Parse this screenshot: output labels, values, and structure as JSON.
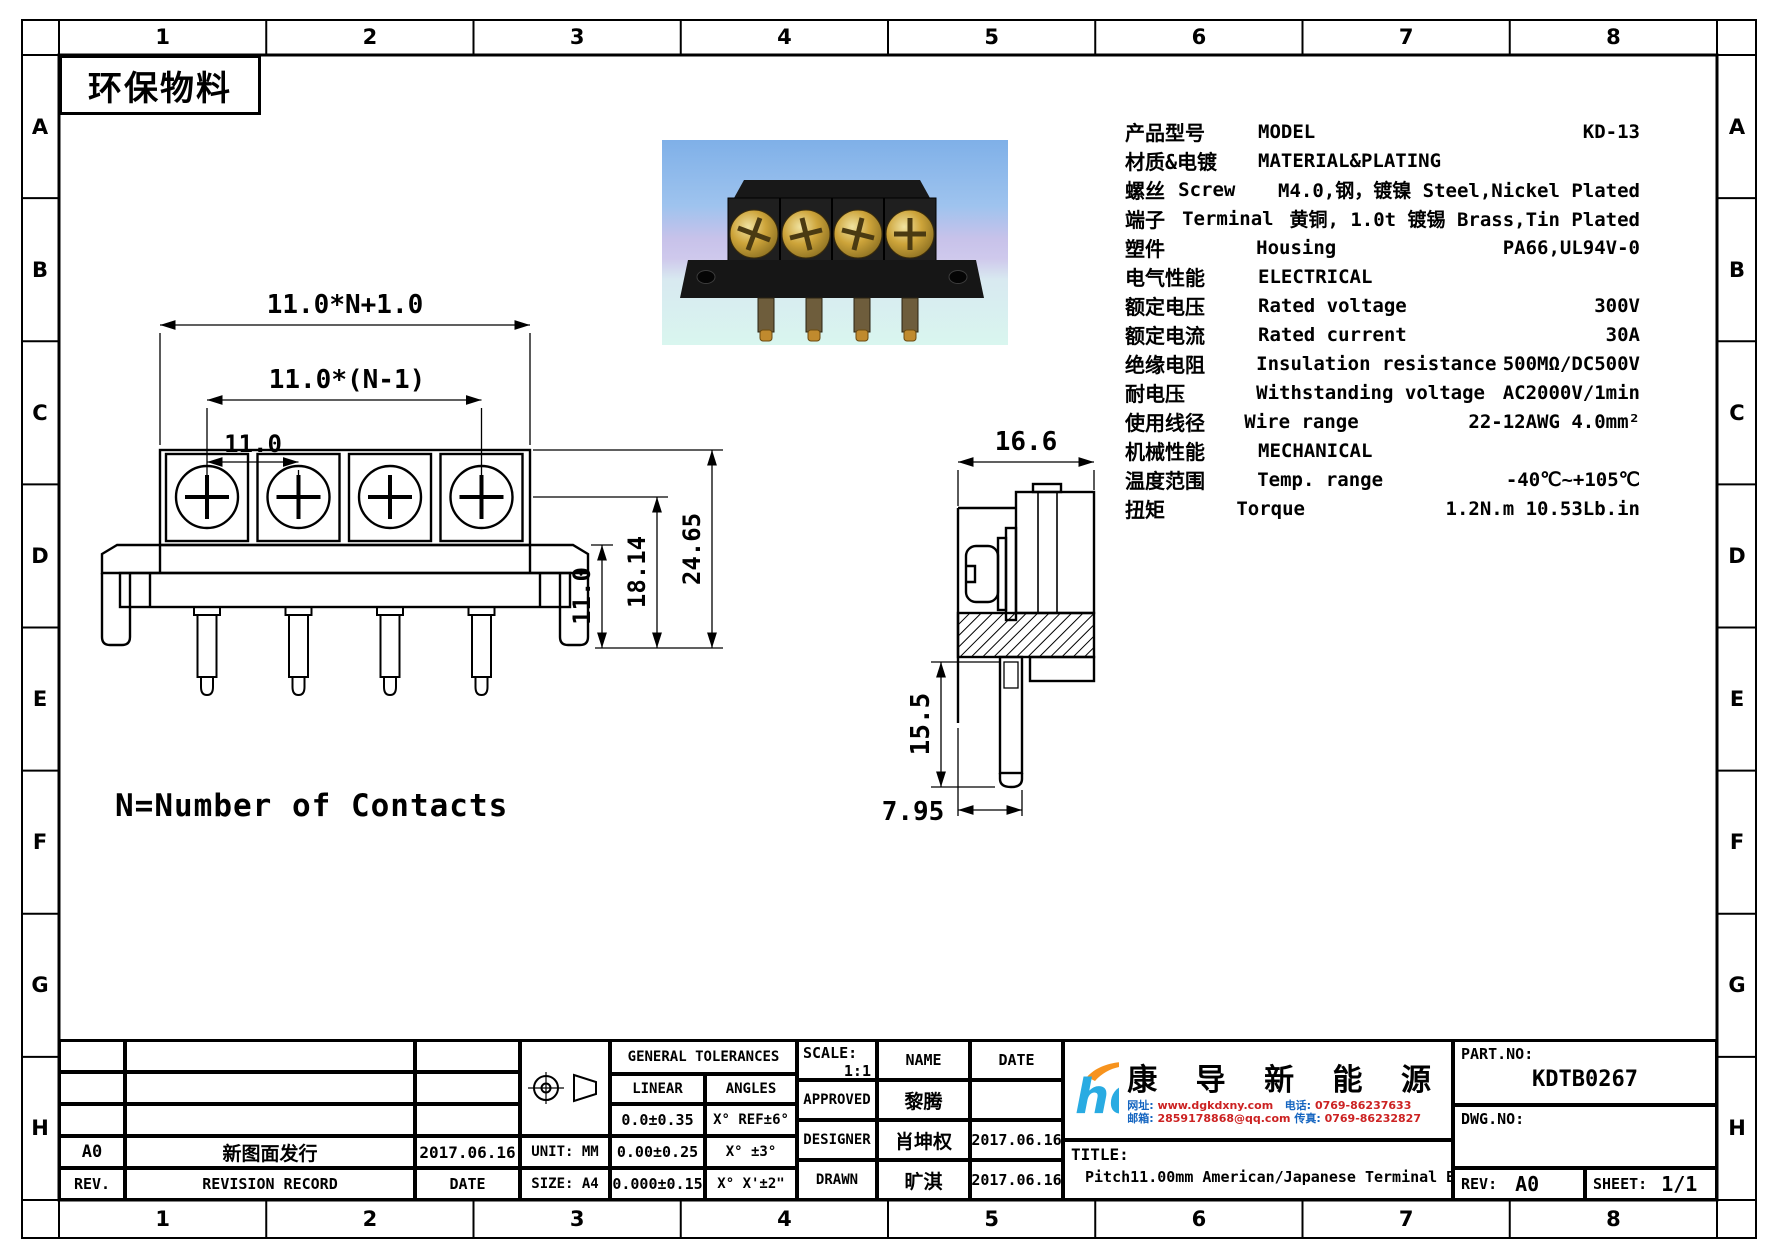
{
  "page": {
    "eco_label": "环保物料",
    "note": "N=Number of Contacts"
  },
  "grid": {
    "cols": [
      "1",
      "2",
      "3",
      "4",
      "5",
      "6",
      "7",
      "8"
    ],
    "rows": [
      "A",
      "B",
      "C",
      "D",
      "E",
      "F",
      "G",
      "H"
    ]
  },
  "specs": {
    "rows": [
      {
        "cn": "产品型号",
        "en": "MODEL",
        "val": "KD-13"
      },
      {
        "cn": "材质&电镀",
        "en": "MATERIAL&PLATING",
        "val": ""
      },
      {
        "cn": "螺丝",
        "en": "Screw",
        "val": "M4.0,钢，镀镍 Steel,Nickel Plated"
      },
      {
        "cn": "端子",
        "en": "Terminal",
        "val": "黄铜, 1.0t 镀锡 Brass,Tin Plated"
      },
      {
        "cn": "塑件",
        "en": "Housing",
        "val": "PA66,UL94V-0"
      },
      {
        "cn": "电气性能",
        "en": "ELECTRICAL",
        "val": ""
      },
      {
        "cn": "额定电压",
        "en": "Rated voltage",
        "val": "300V"
      },
      {
        "cn": "额定电流",
        "en": "Rated current",
        "val": "30A"
      },
      {
        "cn": "绝缘电阻",
        "en": "Insulation resistance",
        "val": "500MΩ/DC500V"
      },
      {
        "cn": "耐电压",
        "en": "Withstanding voltage",
        "val": "AC2000V/1min"
      },
      {
        "cn": "使用线径",
        "en": "Wire range",
        "val": "22-12AWG 4.0mm²"
      },
      {
        "cn": "机械性能",
        "en": "MECHANICAL",
        "val": ""
      },
      {
        "cn": "温度范围",
        "en": "Temp. range",
        "val": "-40℃~+105℃"
      },
      {
        "cn": "扭矩",
        "en": "Torque",
        "val": "1.2N.m  10.53Lb.in"
      }
    ]
  },
  "drawing": {
    "front": {
      "overall": "11.0*N+1.0",
      "span": "11.0*(N-1)",
      "pitch": "11.0",
      "base_h": "11.0",
      "mid_h": "18.14",
      "total_h": "24.65"
    },
    "side": {
      "width": "16.6",
      "pin": "15.5",
      "offset": "7.95"
    }
  },
  "titleblock": {
    "revision": {
      "header": {
        "rev": "REV.",
        "record": "REVISION RECORD",
        "date": "DATE"
      },
      "rows": [
        {
          "rev": "A0",
          "record": "新图面发行",
          "date": "2017.06.16"
        }
      ]
    },
    "unit": "UNIT: MM",
    "size": "SIZE: A4",
    "tolerances": {
      "title": "GENERAL TOLERANCES",
      "linear_label": "LINEAR",
      "angles_label": "ANGLES",
      "rows": [
        {
          "linear": "0.0±0.35",
          "angle": "X° REF±6°"
        },
        {
          "linear": "0.00±0.25",
          "angle": "X° ±3°"
        },
        {
          "linear": "0.000±0.15",
          "angle": "X° X'±2\""
        }
      ]
    },
    "scale_label": "SCALE:",
    "scale_value": "1:1",
    "name_label": "NAME",
    "date_label": "DATE",
    "signoff": [
      {
        "role": "APPROVED",
        "name": "黎腾",
        "date": "2017.06.16"
      },
      {
        "role": "DESIGNER",
        "name": "肖坤权",
        "date": "2017.06.16"
      },
      {
        "role": "DRAWN",
        "name": "旷淇",
        "date": "2017.06.16"
      }
    ],
    "company": {
      "name": "康 导 新 能 源",
      "contacts": {
        "web_label": "网址:",
        "web": "www.dgkdxny.com",
        "tel_label": "电话:",
        "tel": "0769-86237633",
        "mail_label": "邮箱:",
        "mail": "2859178868@qq.com",
        "fax_label": "传真:",
        "fax": "0769-86232827"
      }
    },
    "title_label": "TITLE:",
    "title_value": "Pitch11.00mm American/Japanese Terminal Blocks",
    "part_no_label": "PART.NO:",
    "part_no": "KDTB0267",
    "dwg_no_label": "DWG.NO:",
    "rev_label": "REV:",
    "rev_value": "A0",
    "sheet_label": "SHEET:",
    "sheet_value": "1/1"
  }
}
